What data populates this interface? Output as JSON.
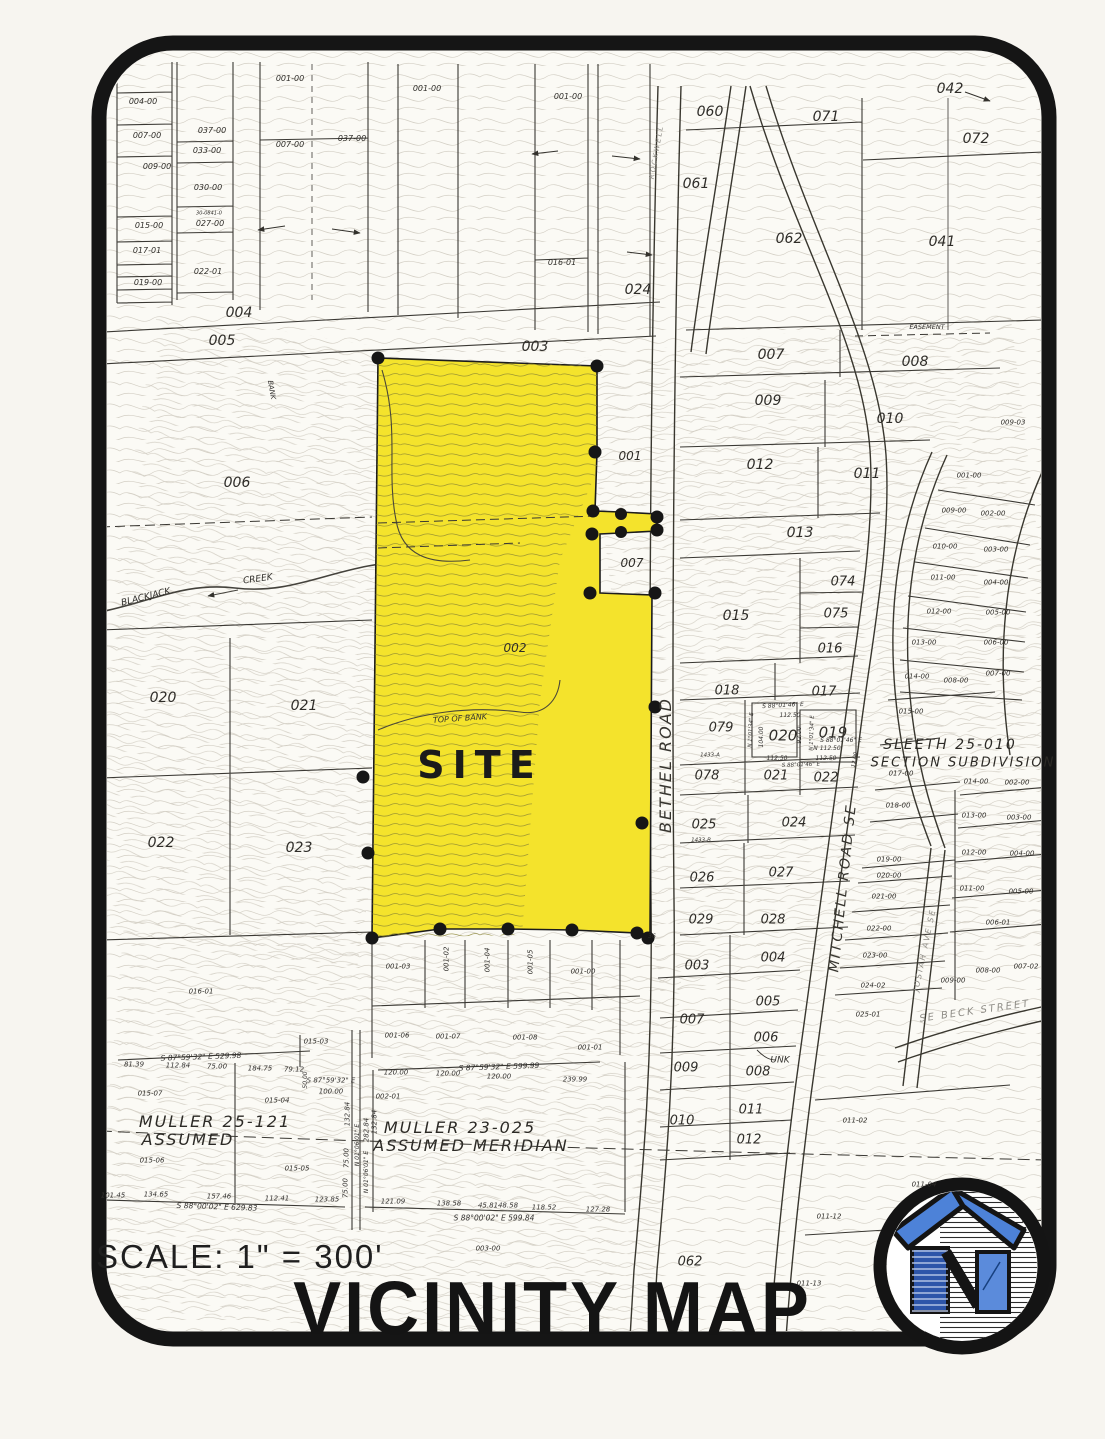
{
  "header": {
    "scale": "SCALE: 1\" = 300'",
    "title": "VICINITY MAP"
  },
  "colors": {
    "site_yellow": "#f4e32c",
    "frame_black": "#151515",
    "contour_gray": "#beb8ab",
    "site_contour_olive": "#8a8433",
    "logo_roof_blue": "#4d82d8",
    "logo_panel_blue": "#2d55a9",
    "logo_window_blue": "#5b8bdb"
  },
  "site": {
    "label": "SITE"
  },
  "labels": [
    {
      "t": "004-00",
      "x": 143,
      "y": 102,
      "s": 8
    },
    {
      "t": "007-00",
      "x": 147,
      "y": 136,
      "s": 8
    },
    {
      "t": "009-00",
      "x": 157,
      "y": 167,
      "s": 8
    },
    {
      "t": "015-00",
      "x": 149,
      "y": 226,
      "s": 8
    },
    {
      "t": "017-01",
      "x": 147,
      "y": 251,
      "s": 8
    },
    {
      "t": "019-00",
      "x": 148,
      "y": 283,
      "s": 8
    },
    {
      "t": "037-00",
      "x": 212,
      "y": 131,
      "s": 8
    },
    {
      "t": "033-00",
      "x": 207,
      "y": 151,
      "s": 8
    },
    {
      "t": "030-00",
      "x": 208,
      "y": 188,
      "s": 8
    },
    {
      "t": "30-0841-0",
      "x": 209,
      "y": 214,
      "s": 5
    },
    {
      "t": "027-00",
      "x": 210,
      "y": 224,
      "s": 8
    },
    {
      "t": "022-01",
      "x": 208,
      "y": 272,
      "s": 8
    },
    {
      "t": "001-00",
      "x": 290,
      "y": 79,
      "s": 8
    },
    {
      "t": "007-00",
      "x": 290,
      "y": 145,
      "s": 8
    },
    {
      "t": "037-00",
      "x": 352,
      "y": 139,
      "s": 8
    },
    {
      "t": "001-00",
      "x": 427,
      "y": 89,
      "s": 8
    },
    {
      "t": "001-00",
      "x": 568,
      "y": 97,
      "s": 8
    },
    {
      "t": "016-01",
      "x": 562,
      "y": 263,
      "s": 8
    },
    {
      "t": "ROCKWELL",
      "x": 657,
      "y": 152,
      "s": 7,
      "r": -80,
      "c": "c-light",
      "n": "road-label-rockwell"
    },
    {
      "t": "004",
      "x": 239,
      "y": 313,
      "s": 14
    },
    {
      "t": "005",
      "x": 222,
      "y": 341,
      "s": 14
    },
    {
      "t": "003",
      "x": 535,
      "y": 347,
      "s": 14
    },
    {
      "t": "060",
      "x": 710,
      "y": 112,
      "s": 14
    },
    {
      "t": "071",
      "x": 826,
      "y": 117,
      "s": 14
    },
    {
      "t": "042",
      "x": 950,
      "y": 89,
      "s": 14
    },
    {
      "t": "072",
      "x": 976,
      "y": 139,
      "s": 14
    },
    {
      "t": "061",
      "x": 696,
      "y": 184,
      "s": 14
    },
    {
      "t": "062",
      "x": 789,
      "y": 239,
      "s": 14
    },
    {
      "t": "041",
      "x": 942,
      "y": 242,
      "s": 14
    },
    {
      "t": "024",
      "x": 638,
      "y": 290,
      "s": 14
    },
    {
      "t": "EASEMENT",
      "x": 927,
      "y": 327,
      "s": 6.5,
      "c": "c-survey"
    },
    {
      "t": "007",
      "x": 771,
      "y": 355,
      "s": 14
    },
    {
      "t": "008",
      "x": 915,
      "y": 362,
      "s": 14
    },
    {
      "t": "009",
      "x": 768,
      "y": 401,
      "s": 14
    },
    {
      "t": "010",
      "x": 890,
      "y": 419,
      "s": 14
    },
    {
      "t": "009-03",
      "x": 1013,
      "y": 423,
      "s": 7
    },
    {
      "t": "012",
      "x": 760,
      "y": 465,
      "s": 14
    },
    {
      "t": "011",
      "x": 867,
      "y": 474,
      "s": 14
    },
    {
      "t": "013",
      "x": 800,
      "y": 533,
      "s": 14
    },
    {
      "t": "074",
      "x": 843,
      "y": 582,
      "s": 13
    },
    {
      "t": "075",
      "x": 836,
      "y": 614,
      "s": 13
    },
    {
      "t": "015",
      "x": 736,
      "y": 616,
      "s": 14
    },
    {
      "t": "016",
      "x": 830,
      "y": 649,
      "s": 13
    },
    {
      "t": "001",
      "x": 630,
      "y": 456,
      "s": 12
    },
    {
      "t": "007",
      "x": 632,
      "y": 563,
      "s": 12
    },
    {
      "t": "002",
      "x": 515,
      "y": 648,
      "s": 12
    },
    {
      "t": "001-00",
      "x": 969,
      "y": 476,
      "s": 7
    },
    {
      "t": "009-00",
      "x": 954,
      "y": 511,
      "s": 7
    },
    {
      "t": "002-00",
      "x": 993,
      "y": 514,
      "s": 7
    },
    {
      "t": "010-00",
      "x": 945,
      "y": 547,
      "s": 7
    },
    {
      "t": "003-00",
      "x": 996,
      "y": 550,
      "s": 7
    },
    {
      "t": "011-00",
      "x": 943,
      "y": 578,
      "s": 7
    },
    {
      "t": "004-00",
      "x": 996,
      "y": 583,
      "s": 7
    },
    {
      "t": "012-00",
      "x": 939,
      "y": 612,
      "s": 7
    },
    {
      "t": "005-00",
      "x": 998,
      "y": 613,
      "s": 7
    },
    {
      "t": "013-00",
      "x": 924,
      "y": 643,
      "s": 7
    },
    {
      "t": "006-00",
      "x": 996,
      "y": 643,
      "s": 7
    },
    {
      "t": "014-00",
      "x": 917,
      "y": 677,
      "s": 7
    },
    {
      "t": "008-00",
      "x": 956,
      "y": 681,
      "s": 7
    },
    {
      "t": "007-00",
      "x": 998,
      "y": 674,
      "s": 7
    },
    {
      "t": "015-00",
      "x": 911,
      "y": 712,
      "s": 7
    },
    {
      "t": "SLEETH 25-010",
      "x": 950,
      "y": 745,
      "s": 14,
      "c": "c-sub",
      "n": "subdivision-label"
    },
    {
      "t": "SECTION SUBDIVISION",
      "x": 963,
      "y": 763,
      "s": 13,
      "c": "c-sub",
      "n": "subdivision-label"
    },
    {
      "t": "017-00",
      "x": 901,
      "y": 774,
      "s": 7
    },
    {
      "t": "018-00",
      "x": 898,
      "y": 806,
      "s": 7
    },
    {
      "t": "019-00",
      "x": 889,
      "y": 860,
      "s": 7
    },
    {
      "t": "020-00",
      "x": 889,
      "y": 876,
      "s": 7
    },
    {
      "t": "021-00",
      "x": 884,
      "y": 897,
      "s": 7
    },
    {
      "t": "022-00",
      "x": 879,
      "y": 929,
      "s": 7
    },
    {
      "t": "014-00",
      "x": 976,
      "y": 782,
      "s": 7
    },
    {
      "t": "002-00",
      "x": 1017,
      "y": 783,
      "s": 7
    },
    {
      "t": "013-00",
      "x": 974,
      "y": 816,
      "s": 7
    },
    {
      "t": "003-00",
      "x": 1019,
      "y": 818,
      "s": 7
    },
    {
      "t": "012-00",
      "x": 974,
      "y": 853,
      "s": 7
    },
    {
      "t": "004-00",
      "x": 1022,
      "y": 854,
      "s": 7
    },
    {
      "t": "011-00",
      "x": 972,
      "y": 889,
      "s": 7
    },
    {
      "t": "005-00",
      "x": 1021,
      "y": 892,
      "s": 7
    },
    {
      "t": "006-01",
      "x": 998,
      "y": 923,
      "s": 7
    },
    {
      "t": "023-00",
      "x": 875,
      "y": 956,
      "s": 7
    },
    {
      "t": "024-02",
      "x": 873,
      "y": 986,
      "s": 7
    },
    {
      "t": "025-01",
      "x": 868,
      "y": 1015,
      "s": 7
    },
    {
      "t": "009-00",
      "x": 953,
      "y": 981,
      "s": 7
    },
    {
      "t": "008-00",
      "x": 988,
      "y": 971,
      "s": 7
    },
    {
      "t": "007-02",
      "x": 1026,
      "y": 967,
      "s": 7
    },
    {
      "t": "SE BECK STREET",
      "x": 975,
      "y": 1012,
      "s": 10,
      "r": -8,
      "c": "c-light",
      "n": "road-label-beck"
    },
    {
      "t": "JOSIAH AVE SE",
      "x": 925,
      "y": 950,
      "s": 8,
      "r": -78,
      "c": "c-light",
      "n": "road-label-josiah"
    },
    {
      "t": "018",
      "x": 727,
      "y": 691,
      "s": 13
    },
    {
      "t": "017",
      "x": 824,
      "y": 692,
      "s": 13
    },
    {
      "t": "079",
      "x": 721,
      "y": 728,
      "s": 13
    },
    {
      "t": "020",
      "x": 783,
      "y": 736,
      "s": 15
    },
    {
      "t": "019",
      "x": 833,
      "y": 733,
      "s": 15
    },
    {
      "t": "078",
      "x": 707,
      "y": 776,
      "s": 13
    },
    {
      "t": "021",
      "x": 776,
      "y": 776,
      "s": 13
    },
    {
      "t": "022",
      "x": 826,
      "y": 778,
      "s": 13
    },
    {
      "t": "025",
      "x": 704,
      "y": 825,
      "s": 13
    },
    {
      "t": "024",
      "x": 794,
      "y": 823,
      "s": 13
    },
    {
      "t": "026",
      "x": 702,
      "y": 878,
      "s": 13
    },
    {
      "t": "027",
      "x": 781,
      "y": 873,
      "s": 13
    },
    {
      "t": "029",
      "x": 701,
      "y": 920,
      "s": 13
    },
    {
      "t": "028",
      "x": 773,
      "y": 920,
      "s": 13
    },
    {
      "t": "1433-A",
      "x": 710,
      "y": 756,
      "s": 5.5
    },
    {
      "t": "1433-B",
      "x": 701,
      "y": 841,
      "s": 5.5
    },
    {
      "t": "S 88°01'46\" E",
      "x": 783,
      "y": 706,
      "s": 6,
      "r": -3,
      "c": "c-survey"
    },
    {
      "t": "112.50",
      "x": 790,
      "y": 716,
      "s": 6,
      "c": "c-survey"
    },
    {
      "t": "104.00",
      "x": 762,
      "y": 737,
      "s": 6,
      "r": -90,
      "c": "c-survey"
    },
    {
      "t": "N 1°01'34\" E",
      "x": 752,
      "y": 730,
      "s": 5.5,
      "r": -87,
      "c": "c-survey"
    },
    {
      "t": "92.00",
      "x": 800,
      "y": 735,
      "s": 6,
      "r": -90,
      "c": "c-survey"
    },
    {
      "t": "N 1°01'34\" E",
      "x": 813,
      "y": 733,
      "s": 5.5,
      "r": -88,
      "c": "c-survey"
    },
    {
      "t": "S 88°01'46\" E",
      "x": 841,
      "y": 741,
      "s": 6,
      "c": "c-survey"
    },
    {
      "t": "N 112.50",
      "x": 827,
      "y": 749,
      "s": 6,
      "c": "c-survey"
    },
    {
      "t": "112.50",
      "x": 777,
      "y": 759,
      "s": 6,
      "c": "c-survey"
    },
    {
      "t": "112.50",
      "x": 826,
      "y": 759,
      "s": 6,
      "c": "c-survey"
    },
    {
      "t": "S 88°01'46\" E",
      "x": 801,
      "y": 766,
      "s": 5.5,
      "r": -2,
      "c": "c-survey"
    },
    {
      "t": "12.00",
      "x": 856,
      "y": 760,
      "s": 5.5,
      "r": -80,
      "c": "c-survey"
    },
    {
      "t": "006",
      "x": 237,
      "y": 483,
      "s": 14
    },
    {
      "t": "BLACKJACK",
      "x": 146,
      "y": 598,
      "s": 9,
      "r": -14,
      "n": "creek-label"
    },
    {
      "t": "CREEK",
      "x": 258,
      "y": 580,
      "s": 9,
      "r": -8,
      "n": "creek-label"
    },
    {
      "t": "020",
      "x": 163,
      "y": 698,
      "s": 14
    },
    {
      "t": "021",
      "x": 304,
      "y": 706,
      "s": 14
    },
    {
      "t": "022",
      "x": 161,
      "y": 843,
      "s": 14
    },
    {
      "t": "023",
      "x": 299,
      "y": 848,
      "s": 14
    },
    {
      "t": "TOP  OF  BANK",
      "x": 460,
      "y": 719,
      "s": 8,
      "r": -4,
      "c": "c-survey"
    },
    {
      "t": "BANK",
      "x": 271,
      "y": 390,
      "s": 7,
      "r": 80,
      "c": "c-survey"
    },
    {
      "t": "SITE",
      "x": 480,
      "y": 765,
      "s": 38,
      "c": "c-site",
      "n": "site-label"
    },
    {
      "t": "BETHEL ROAD",
      "x": 666,
      "y": 765,
      "s": 16,
      "r": -90,
      "c": "c-road",
      "n": "road-label-bethel"
    },
    {
      "t": "MITCHELL ROAD SE",
      "x": 843,
      "y": 888,
      "s": 14,
      "r": -84,
      "c": "c-road",
      "n": "road-label-mitchell"
    },
    {
      "t": "UNK",
      "x": 780,
      "y": 1061,
      "s": 9
    },
    {
      "t": "36",
      "x": 652,
      "y": 937,
      "s": 6
    },
    {
      "t": "001-03",
      "x": 398,
      "y": 967,
      "s": 7
    },
    {
      "t": "001-02",
      "x": 447,
      "y": 959,
      "s": 7,
      "r": -90
    },
    {
      "t": "001-04",
      "x": 488,
      "y": 960,
      "s": 7,
      "r": -90
    },
    {
      "t": "001-05",
      "x": 531,
      "y": 962,
      "s": 7,
      "r": -90
    },
    {
      "t": "001-00",
      "x": 583,
      "y": 972,
      "s": 7
    },
    {
      "t": "001-06",
      "x": 397,
      "y": 1036,
      "s": 7
    },
    {
      "t": "001-07",
      "x": 448,
      "y": 1037,
      "s": 7
    },
    {
      "t": "001-08",
      "x": 525,
      "y": 1038,
      "s": 7
    },
    {
      "t": "001-01",
      "x": 590,
      "y": 1048,
      "s": 7
    },
    {
      "t": "016-01",
      "x": 201,
      "y": 992,
      "s": 7
    },
    {
      "t": "015-07",
      "x": 150,
      "y": 1094,
      "s": 7
    },
    {
      "t": "015-04",
      "x": 277,
      "y": 1101,
      "s": 7
    },
    {
      "t": "015-03",
      "x": 316,
      "y": 1042,
      "s": 7
    },
    {
      "t": "015-06",
      "x": 152,
      "y": 1161,
      "s": 7
    },
    {
      "t": "015-05",
      "x": 297,
      "y": 1169,
      "s": 7
    },
    {
      "t": "002-01",
      "x": 388,
      "y": 1097,
      "s": 7
    },
    {
      "t": "003",
      "x": 697,
      "y": 966,
      "s": 13
    },
    {
      "t": "004",
      "x": 773,
      "y": 958,
      "s": 13
    },
    {
      "t": "005",
      "x": 768,
      "y": 1002,
      "s": 13
    },
    {
      "t": "007",
      "x": 692,
      "y": 1020,
      "s": 13
    },
    {
      "t": "006",
      "x": 766,
      "y": 1038,
      "s": 13
    },
    {
      "t": "009",
      "x": 686,
      "y": 1068,
      "s": 13
    },
    {
      "t": "008",
      "x": 758,
      "y": 1072,
      "s": 13
    },
    {
      "t": "011",
      "x": 751,
      "y": 1110,
      "s": 13
    },
    {
      "t": "010",
      "x": 682,
      "y": 1121,
      "s": 13
    },
    {
      "t": "012",
      "x": 749,
      "y": 1140,
      "s": 13
    },
    {
      "t": "011-02",
      "x": 855,
      "y": 1121,
      "s": 7
    },
    {
      "t": "011-04",
      "x": 924,
      "y": 1185,
      "s": 7
    },
    {
      "t": "011-12",
      "x": 829,
      "y": 1217,
      "s": 7
    },
    {
      "t": "011-13",
      "x": 809,
      "y": 1284,
      "s": 7
    },
    {
      "t": "062",
      "x": 690,
      "y": 1262,
      "s": 13
    },
    {
      "t": "003-00",
      "x": 488,
      "y": 1249,
      "s": 7
    },
    {
      "t": "MULLER 25-121",
      "x": 215,
      "y": 1122,
      "s": 16,
      "c": "c-sub",
      "n": "survey-block-label"
    },
    {
      "t": "ASSUMED",
      "x": 188,
      "y": 1140,
      "s": 16,
      "c": "c-sub",
      "n": "survey-block-label"
    },
    {
      "t": "MULLER 23-025",
      "x": 460,
      "y": 1128,
      "s": 16,
      "c": "c-sub",
      "n": "survey-block-label"
    },
    {
      "t": "ASSUMED MERIDIAN",
      "x": 471,
      "y": 1146,
      "s": 16,
      "c": "c-sub",
      "n": "survey-block-label"
    },
    {
      "t": "S 87°59'32\" E 529.98",
      "x": 201,
      "y": 1057,
      "s": 7.5,
      "r": -2,
      "c": "c-survey"
    },
    {
      "t": "81.39",
      "x": 134,
      "y": 1065,
      "s": 7,
      "c": "c-survey"
    },
    {
      "t": "112.84",
      "x": 178,
      "y": 1066,
      "s": 7,
      "c": "c-survey"
    },
    {
      "t": "75.00",
      "x": 217,
      "y": 1067,
      "s": 7,
      "c": "c-survey"
    },
    {
      "t": "184.75",
      "x": 260,
      "y": 1069,
      "s": 7,
      "c": "c-survey"
    },
    {
      "t": "79.12",
      "x": 294,
      "y": 1070,
      "s": 7,
      "c": "c-survey"
    },
    {
      "t": "S 87°59'32\" E",
      "x": 331,
      "y": 1081,
      "s": 7,
      "c": "c-survey"
    },
    {
      "t": "100.00",
      "x": 331,
      "y": 1092,
      "s": 7,
      "c": "c-survey"
    },
    {
      "t": "50.00",
      "x": 306,
      "y": 1080,
      "s": 6,
      "r": -90,
      "c": "c-survey"
    },
    {
      "t": "S 88°00'02\" E 629.83",
      "x": 217,
      "y": 1207,
      "s": 7.5,
      "r": 2,
      "c": "c-survey"
    },
    {
      "t": "101.45",
      "x": 113,
      "y": 1196,
      "s": 7,
      "c": "c-survey"
    },
    {
      "t": "134.65",
      "x": 156,
      "y": 1195,
      "s": 7,
      "c": "c-survey"
    },
    {
      "t": "157.46",
      "x": 219,
      "y": 1197,
      "s": 7,
      "c": "c-survey"
    },
    {
      "t": "112.41",
      "x": 277,
      "y": 1199,
      "s": 7,
      "c": "c-survey"
    },
    {
      "t": "123.85",
      "x": 327,
      "y": 1200,
      "s": 7,
      "c": "c-survey"
    },
    {
      "t": "S 87°59'32\" E 599.99",
      "x": 499,
      "y": 1067,
      "s": 7.5,
      "r": -2,
      "c": "c-survey"
    },
    {
      "t": "120.00",
      "x": 396,
      "y": 1073,
      "s": 7,
      "c": "c-survey"
    },
    {
      "t": "120.00",
      "x": 448,
      "y": 1074,
      "s": 7,
      "c": "c-survey"
    },
    {
      "t": "120.00",
      "x": 499,
      "y": 1077,
      "s": 7,
      "c": "c-survey"
    },
    {
      "t": "239.99",
      "x": 575,
      "y": 1080,
      "s": 7,
      "c": "c-survey"
    },
    {
      "t": "S 88°00'02\" E 599.84",
      "x": 494,
      "y": 1218,
      "s": 7.5,
      "c": "c-survey"
    },
    {
      "t": "121.09",
      "x": 393,
      "y": 1202,
      "s": 7,
      "c": "c-survey"
    },
    {
      "t": "138.58",
      "x": 449,
      "y": 1204,
      "s": 7,
      "c": "c-survey"
    },
    {
      "t": "45.81",
      "x": 488,
      "y": 1206,
      "s": 7,
      "c": "c-survey"
    },
    {
      "t": "48.58",
      "x": 508,
      "y": 1206,
      "s": 7,
      "c": "c-survey"
    },
    {
      "t": "118.52",
      "x": 544,
      "y": 1208,
      "s": 7,
      "c": "c-survey"
    },
    {
      "t": "127.28",
      "x": 598,
      "y": 1210,
      "s": 7,
      "c": "c-survey"
    },
    {
      "t": "132.84",
      "x": 348,
      "y": 1114,
      "s": 7,
      "r": -90,
      "c": "c-survey"
    },
    {
      "t": "282.84",
      "x": 367,
      "y": 1130,
      "s": 7,
      "r": -90,
      "c": "c-survey"
    },
    {
      "t": "N 01°06'01\" E",
      "x": 358,
      "y": 1145,
      "s": 6,
      "r": -90,
      "c": "c-survey"
    },
    {
      "t": "N 01°06'01\" E",
      "x": 367,
      "y": 1172,
      "s": 6,
      "r": -90,
      "c": "c-survey"
    },
    {
      "t": "75.00",
      "x": 347,
      "y": 1158,
      "s": 7,
      "r": -90,
      "c": "c-survey"
    },
    {
      "t": "75.00",
      "x": 346,
      "y": 1188,
      "s": 7,
      "r": -90,
      "c": "c-survey"
    },
    {
      "t": "132.84",
      "x": 375,
      "y": 1122,
      "s": 7,
      "r": -90,
      "c": "c-survey"
    }
  ]
}
